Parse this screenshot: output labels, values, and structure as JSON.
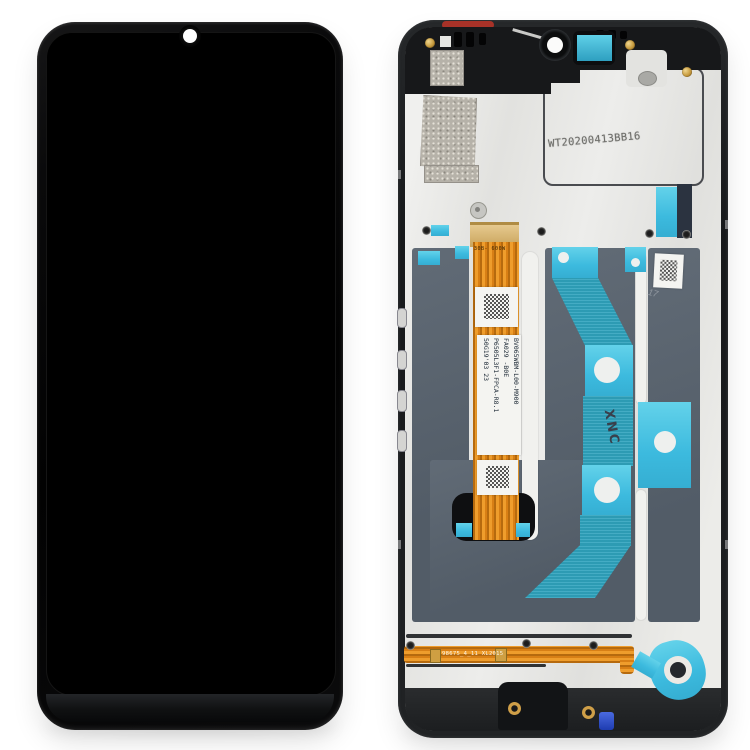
{
  "scene": {
    "type": "product-photo",
    "subject": "Smartphone LCD screen and digitizer full assembly with frame: front view (left) and rear frame view (right)",
    "background_color": "#ffffff"
  },
  "front_unit": {
    "body_color": "#0a0a0b",
    "screen_color": "#000000",
    "camera_dot_color": "#fdfdfd"
  },
  "back_unit": {
    "colors": {
      "frame": "#1b1d1f",
      "backplate_silver": "#e8e8e5",
      "display_window_slate": "#5a6470",
      "tape_bright_cyan": "#3cbade",
      "tape_textured_teal": "#2fa3bd",
      "flex_cable_orange": "#e0881c",
      "connector_gold": "#d9b878",
      "screw_brass": "#c79b3e",
      "clip_blue": "#2b50d8",
      "gasket_red": "#a83228"
    },
    "markings": {
      "plate_stamp": "WT20200413BB16",
      "flex_label_lines": [
        "BV065WBM-L00-M900",
        "FA029  -B0E",
        "P6505L3F1-FPCA-R8.1",
        "50G19'03 23"
      ],
      "flex_top_code": "30B- 600W",
      "bottom_flex_code": "98675_4_11 XL2015",
      "tape_handwriting": "XNC",
      "pencil_mark": "17"
    }
  }
}
